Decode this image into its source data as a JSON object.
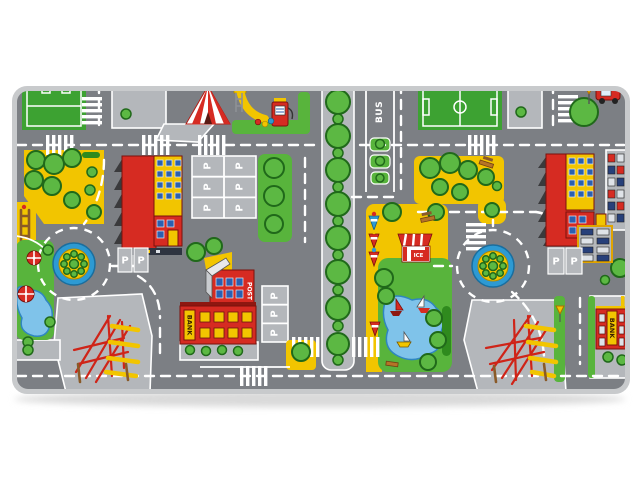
{
  "colors": {
    "background": "#ffffff",
    "shadow": "#d9d9d9",
    "binding": "#c8cacc",
    "road": "#7c7f84",
    "block": "#b4b7bb",
    "grass": "#58b43c",
    "field": "#3da232",
    "yellow": "#f2c500",
    "tree": "#5cb843",
    "tree_dark": "#20691a",
    "hedge": "#2f8a1e",
    "red": "#d62b22",
    "red_dark": "#8e1710",
    "water": "#7fc3ea",
    "water_dark": "#2f86c0",
    "marking": "#ffffff",
    "roundabout_blue": "#2d9ad3",
    "window_blue": "#2b5fb0",
    "wood": "#8a5a28",
    "dark": "#3a3a3c"
  },
  "labels": {
    "bus": "BUS",
    "bank": "BANK",
    "post": "POST",
    "ice": "ICE",
    "parking": "P"
  }
}
